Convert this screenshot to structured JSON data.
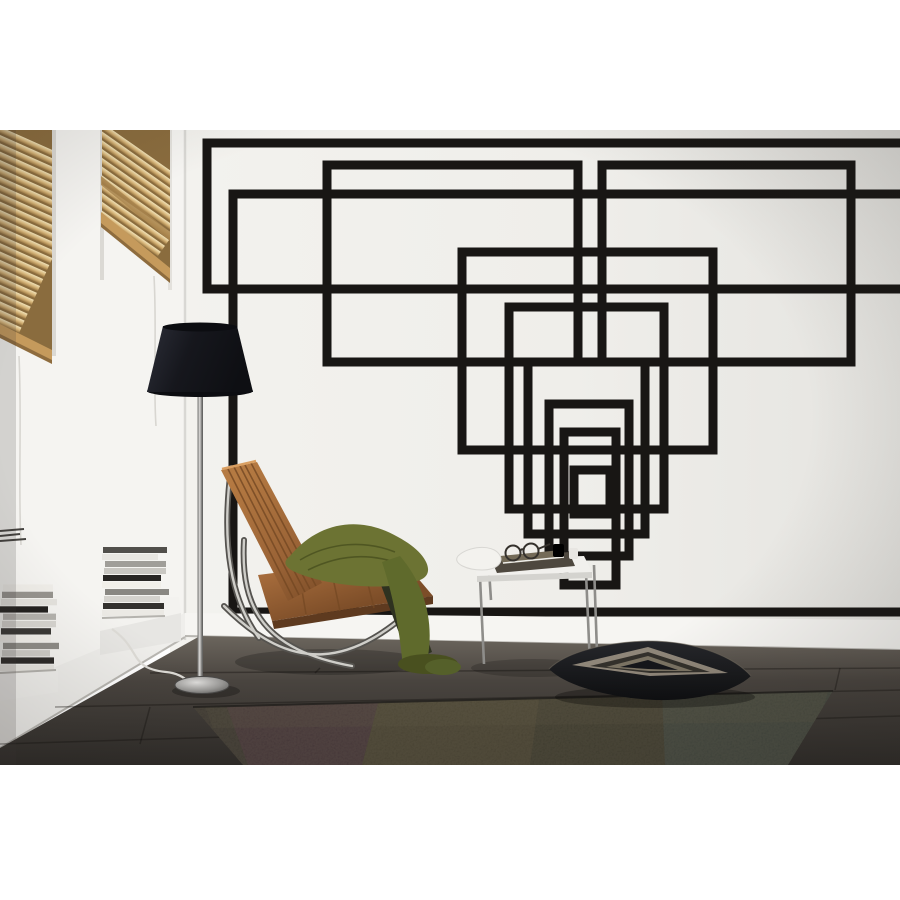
{
  "scene": {
    "alt": "Living room photo: white wall with black geometric rectangle tape decal, wooden venetian blinds on two left windows, stacked magazines, chrome floor lamp with black shade, caramel leather lounge chair with olive green throw, chrome side table with glasses and tray, black patterned floor cushion and dark patchwork rug on grey wood floor"
  },
  "palette": {
    "white": "#ffffff",
    "tape": "#181614",
    "wall": "#efeeea",
    "wallDark": "#e4e3df",
    "leftWall": "#f5f4f1",
    "baseboard": "#f6f5f2",
    "blindBase": "#8a6c3e",
    "rail": "#c59a5c",
    "railDark": "#8e6c3e",
    "floorLight": "#6b655d",
    "floorDark": "#2e2b28",
    "rugBase": "#37332e",
    "shadeDark": "#101116",
    "pole": "#a3a2a0",
    "leather": "#a26b3e",
    "leatherDark": "#6e4424",
    "leatherEdge": "#d99f62",
    "throwGreen": "#6c7333",
    "throwDark": "#49501f",
    "chrome": "#cfcec9",
    "chromeDark": "#55534f",
    "tableTop": "#f1f0ed",
    "pillowBandLight": "#8f8679",
    "pillowBandDark": "#33302b"
  },
  "wall_art": {
    "stroke_width": 9,
    "rects": [
      {
        "name": "decal-rect-top-huge",
        "x": 207,
        "y": 143,
        "w": 725,
        "h": 146
      },
      {
        "name": "decal-rect-upper-left",
        "x": 327,
        "y": 165,
        "w": 251,
        "h": 197
      },
      {
        "name": "decal-rect-upper-right",
        "x": 602,
        "y": 165,
        "w": 249,
        "h": 197
      },
      {
        "name": "decal-rect-wide-tall",
        "x": 233,
        "y": 194,
        "w": 699,
        "h": 418
      },
      {
        "name": "decal-rect-mid-wide",
        "x": 462,
        "y": 252,
        "w": 251,
        "h": 198
      },
      {
        "name": "decal-rect-mid",
        "x": 509,
        "y": 307,
        "w": 155,
        "h": 202
      },
      {
        "name": "decal-rect-lower-1",
        "x": 528,
        "y": 362,
        "w": 117,
        "h": 172
      },
      {
        "name": "decal-rect-lower-2",
        "x": 549,
        "y": 404,
        "w": 80,
        "h": 152
      },
      {
        "name": "decal-rect-lower-3",
        "x": 564,
        "y": 432,
        "w": 52,
        "h": 153
      },
      {
        "name": "decal-rect-smallest",
        "x": 574,
        "y": 470,
        "w": 36,
        "h": 44
      }
    ]
  },
  "blinds": {
    "left": {
      "count": 28,
      "spacing": 7.6,
      "x": -30,
      "width": 130,
      "top": 127,
      "angle": 24,
      "px": 0,
      "py": 130
    },
    "right": {
      "count": 24,
      "spacing": 7.2,
      "x": 80,
      "width": 140,
      "top": 124,
      "angle": 35,
      "px": 102,
      "py": 130
    }
  },
  "books": {
    "stack_a": {
      "x": 0,
      "w": 54,
      "yb": 672,
      "h": 7.3,
      "colors": [
        "#e8e6e1",
        "#2c2a28",
        "#cfcdc8",
        "#8f8d88",
        "#f2f0eb",
        "#3a3835",
        "#d8d6d1",
        "#b5b3ae",
        "#23211f",
        "#e5e3de",
        "#97948f",
        "#f0eee9"
      ]
    },
    "stack_b": {
      "x": 102,
      "w": 62,
      "yb": 617,
      "h": 7.0,
      "colors": [
        "#ebe9e4",
        "#33312e",
        "#d5d3ce",
        "#8a8883",
        "#f1efe9",
        "#282624",
        "#c9c7c2",
        "#a09e99",
        "#e8e6e1",
        "#514f4b"
      ]
    }
  }
}
